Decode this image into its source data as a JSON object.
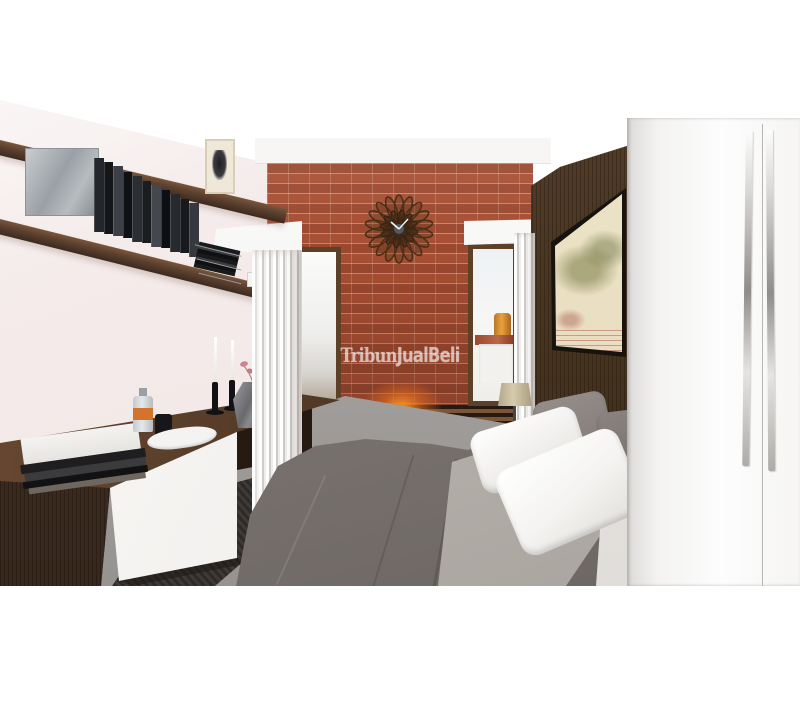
{
  "image": {
    "type": "3d-interior-render-photo",
    "room": "bedroom",
    "watermark": {
      "text": "TribunJualBeli",
      "part1": "Tribun",
      "part2": "JualBeli",
      "color": "rgba(255,255,255,0.52)"
    },
    "colors": {
      "background": "#ffffff",
      "wall": "#f1e7e6",
      "brick": "#a64e33",
      "mortar": "#debaa4",
      "wood_dark": "#46331f",
      "wood_walnut": "#5d4130",
      "floor_gray": "#a5a2a0",
      "carpet_dark": "#34302d",
      "duvet_gray": "#7d7672",
      "sheet_light_gray": "#b7b1ac",
      "pillow_white": "#f4f3f1",
      "pillow_gray": "#8a837f",
      "wardrobe_white": "#fbfbfb",
      "handle_chrome": "#b5b3b1",
      "column_white": "#efedec",
      "lamp_shade": "#cfc3a5",
      "map_cream": "#e8ddc0",
      "accent_light_orange": "#e8821e",
      "flower_pink": "#d98a9a",
      "clock_wood": "#4a3018"
    },
    "objects": [
      "exposed red brick accent wall",
      "sunburst wooden wall clock",
      "orange accent wall light",
      "two wooden-framed windows flanking brick wall",
      "fluted white columns with capitals",
      "floating walnut wall shelves",
      "row of book spines",
      "decorative metal box",
      "small framed picture",
      "wire magazine rack",
      "floating walnut media console with white drawer front",
      "stack of books on console",
      "glass bottle with orange label",
      "black cup",
      "white tray with papers",
      "two black candlesticks with white taper candles",
      "faceted gray vase with pink orchid",
      "bed with gray duvet, light gray throw and white pillows",
      "table lamp with beige drum shade",
      "dark wood plank headboard wall",
      "large framed antique map",
      "white wardrobe with long chrome handles",
      "dark textured rug",
      "gray floor"
    ]
  }
}
